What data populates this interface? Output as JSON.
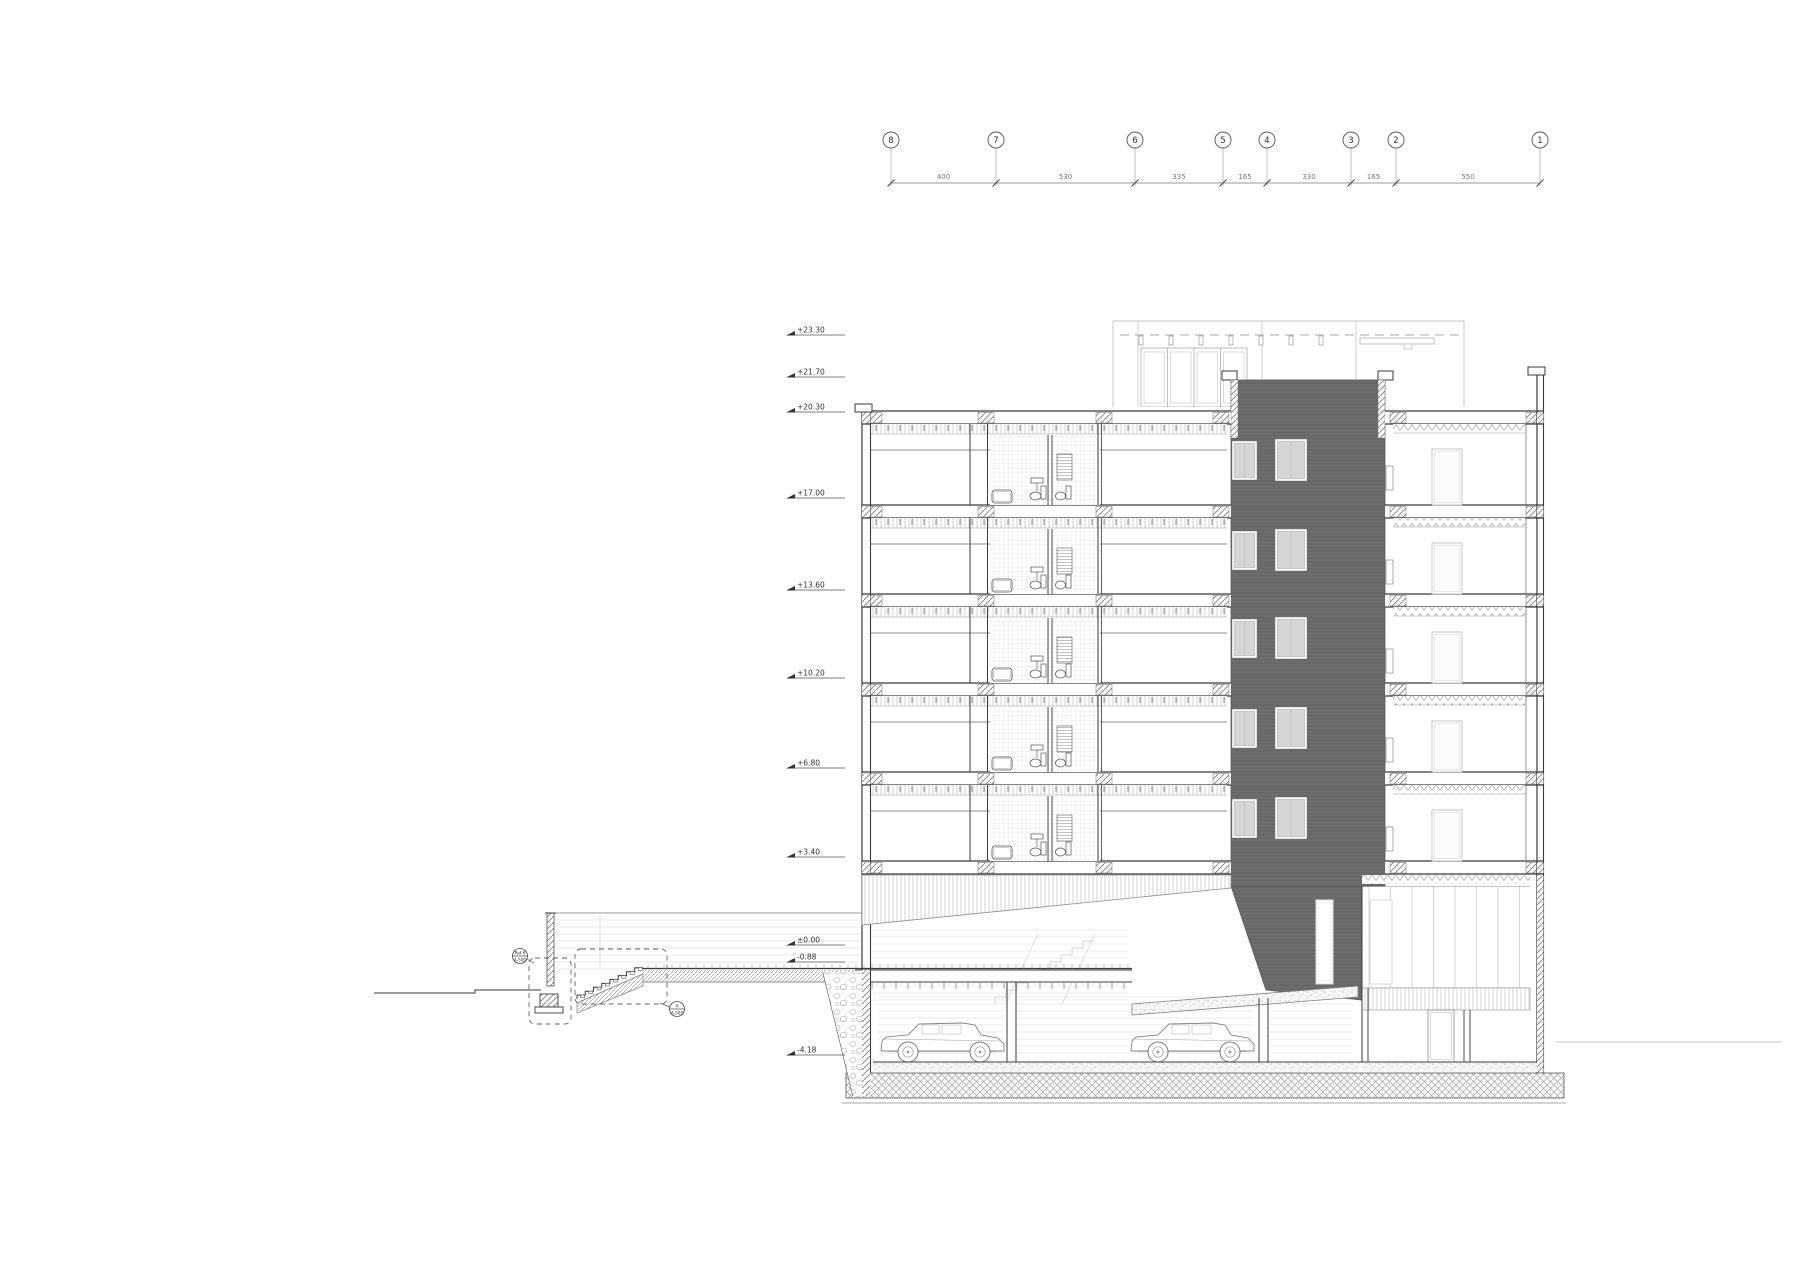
{
  "drawing": {
    "type": "architectural-building-cross-section",
    "floors_above_ground": 5,
    "cars_in_garage": 2
  },
  "grid": {
    "bubbles": [
      {
        "label": "8"
      },
      {
        "label": "7"
      },
      {
        "label": "6"
      },
      {
        "label": "5"
      },
      {
        "label": "4"
      },
      {
        "label": "3"
      },
      {
        "label": "2"
      },
      {
        "label": "1"
      }
    ],
    "dims": [
      "400",
      "530",
      "335",
      "165",
      "330",
      "165",
      "550"
    ]
  },
  "elevations": [
    {
      "label": "+23.30"
    },
    {
      "label": "+21.70"
    },
    {
      "label": "+20.30"
    },
    {
      "label": "+17.00"
    },
    {
      "label": "+13.60"
    },
    {
      "label": "+10.20"
    },
    {
      "label": "+6.80"
    },
    {
      "label": "+3.40"
    },
    {
      "label": "±0.00"
    },
    {
      "label": "-0.88"
    },
    {
      "label": "-4.18"
    }
  ],
  "markers": [
    {
      "top": "Ref 6",
      "bottom": "A-500"
    },
    {
      "top": "A",
      "bottom": "A-500"
    }
  ],
  "colors": {
    "ink": "#3a3a3a",
    "medium": "#8a8a8a",
    "light": "#c7c7c7",
    "core_fill": "#6d6d6d",
    "core_stripe": "#646464",
    "window_fill": "#d6d6d6"
  }
}
